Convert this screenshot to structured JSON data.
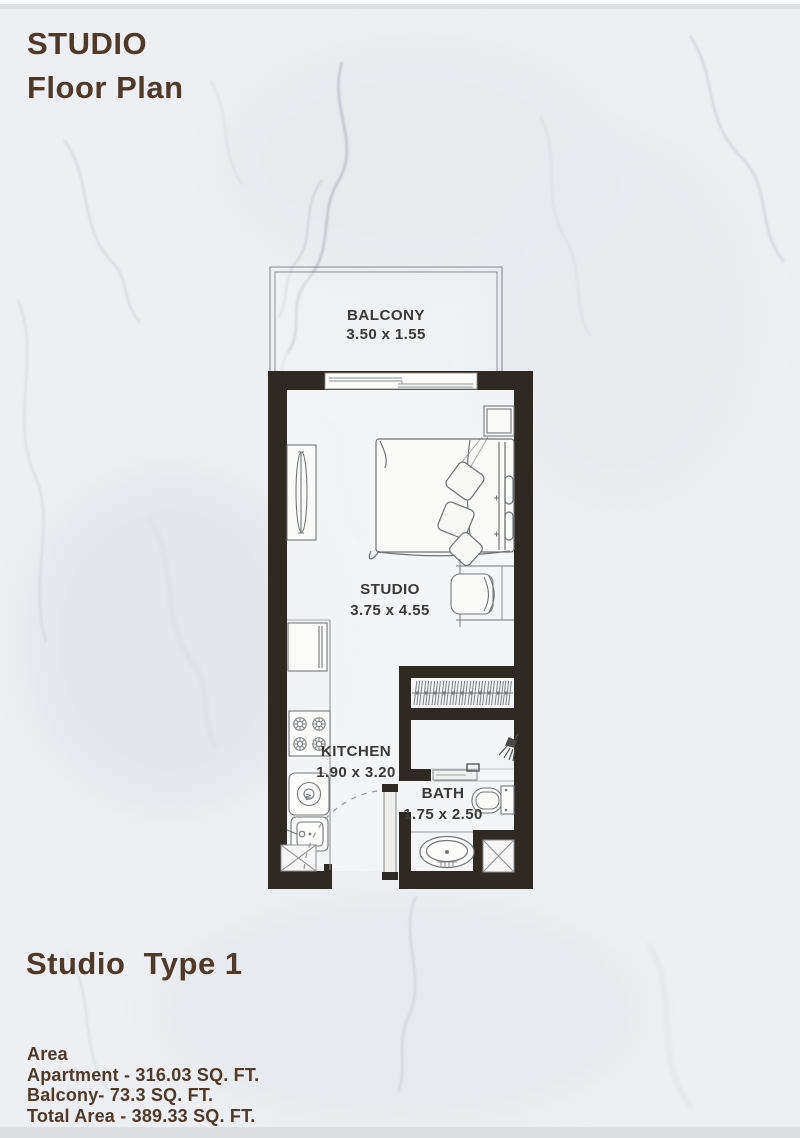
{
  "header": {
    "title_line1": "STUDIO",
    "title_line2": "Floor Plan"
  },
  "plan": {
    "rooms": {
      "balcony": {
        "name": "BALCONY",
        "dims": "3.50 x 1.55"
      },
      "studio": {
        "name": "STUDIO",
        "dims": "3.75 x 4.55"
      },
      "kitchen": {
        "name": "KITCHEN",
        "dims": "1.90 x 3.20"
      },
      "bath": {
        "name": "BATH",
        "dims": "1.75 x 2.50"
      }
    },
    "washer_letter": "W"
  },
  "footer": {
    "type_label": "Studio  Type 1",
    "area_heading": "Area",
    "lines": {
      "apartment": "Apartment - 316.03 SQ. FT.",
      "balcony": "Balcony- 73.3 SQ. FT.",
      "total": "Total Area - 389.33 SQ. FT."
    }
  },
  "colors": {
    "accent_brown": "#4d3a2b",
    "wall": "#2e2922",
    "plan_label": "#3b3936",
    "background": "#edeff2"
  }
}
